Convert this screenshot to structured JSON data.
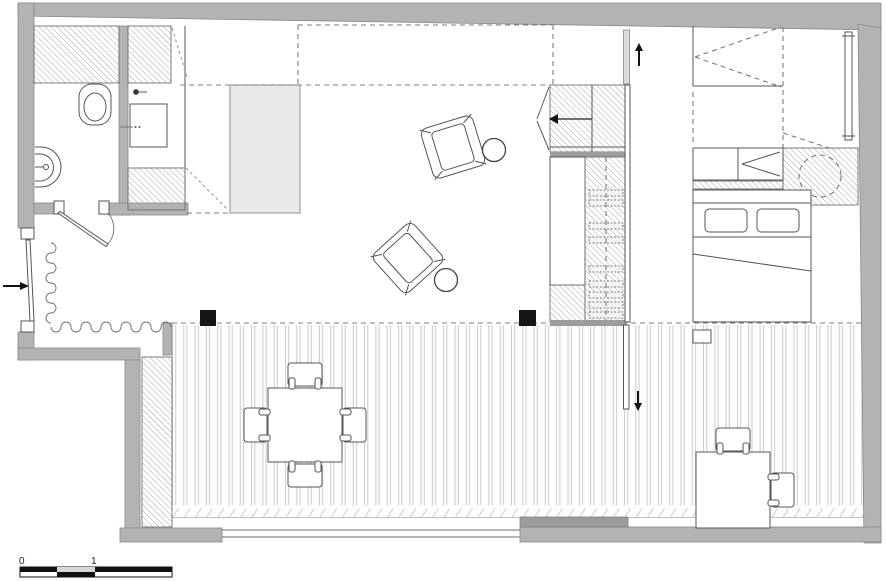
{
  "document": {
    "type": "architectural-floor-plan",
    "background": "#ffffff"
  },
  "scale_bar": {
    "label_zero": "0",
    "label_one": "1"
  },
  "colors": {
    "wall": "#b3b3b3",
    "wall_dark": "#9c9c9c",
    "outline": "#555555",
    "hatch_line": "#a8a8a8",
    "island_fill": "#e9e9e9",
    "deck_line": "#c9c9c9",
    "column_fill": "#161616",
    "glass_fill": "#dcdcdc",
    "dash_line": "#7c7c7c",
    "arrow": "#111111"
  },
  "arrows": {
    "entry": "right-arrow",
    "stairs_top": "up-arrow",
    "stairs_bottom": "down-arrow"
  },
  "areas": [
    "bathroom",
    "kitchen",
    "entry",
    "living-area",
    "staircase",
    "bedroom",
    "terrace"
  ],
  "furniture": [
    "toilet",
    "washbasin",
    "kitchen-sink",
    "kitchen-island",
    "armchair",
    "armchair",
    "side-table",
    "side-table",
    "wardrobe",
    "under-stair-storage",
    "stair-treads",
    "bed",
    "pillow",
    "pillow",
    "dresser",
    "washing-machine",
    "radiator",
    "outdoor-dining-table",
    "outdoor-chair",
    "outdoor-chair",
    "outdoor-chair",
    "outdoor-chair",
    "outdoor-desk",
    "desk-chair",
    "desk-chair",
    "structural-column",
    "structural-column",
    "curtain",
    "entry-door",
    "bathroom-door",
    "deck-flooring"
  ]
}
